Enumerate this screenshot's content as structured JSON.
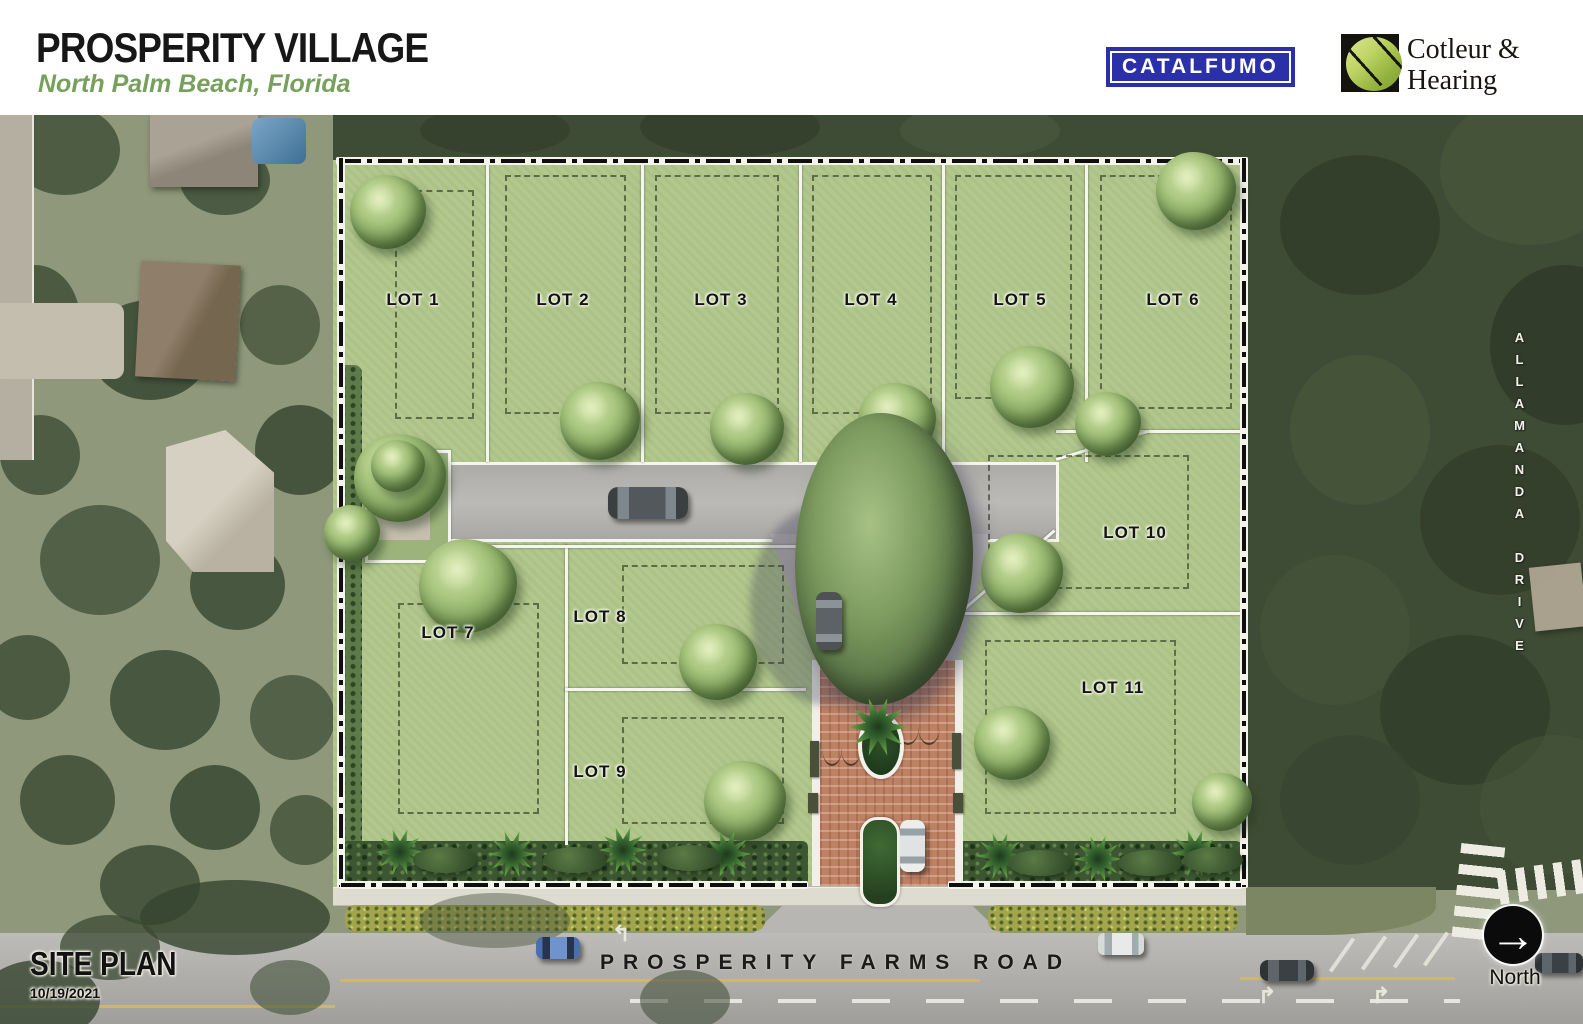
{
  "header": {
    "title": "PROSPERITY VILLAGE",
    "subtitle": "North Palm Beach, Florida",
    "catalfumo_logo": "CATALFUMO",
    "cotleur_logo_line1": "Cotleur &",
    "cotleur_logo_line2": "Hearing"
  },
  "site_plan": {
    "lots": [
      {
        "label": "LOT 1"
      },
      {
        "label": "LOT 2"
      },
      {
        "label": "LOT 3"
      },
      {
        "label": "LOT 4"
      },
      {
        "label": "LOT 5"
      },
      {
        "label": "LOT 6"
      },
      {
        "label": "LOT 7"
      },
      {
        "label": "LOT 8"
      },
      {
        "label": "LOT 9"
      },
      {
        "label": "LOT 10"
      },
      {
        "label": "LOT 11"
      }
    ],
    "streets": {
      "bottom_road": "PROSPERITY FARMS ROAD",
      "right_road": "ALLAMANDA DRIVE"
    },
    "annotations": {
      "plan_label": "SITE PLAN",
      "plan_date": "10/19/2021",
      "north_label": "North",
      "north_arrow": "→"
    },
    "colors": {
      "lot_green": "#b2c78d",
      "forest_green": "#3f4c35",
      "road_gray": "#b7b5b1",
      "brick_red": "#bd8164",
      "catalfumo_blue": "#2b2fa8",
      "subtitle_green": "#76a05c"
    }
  }
}
